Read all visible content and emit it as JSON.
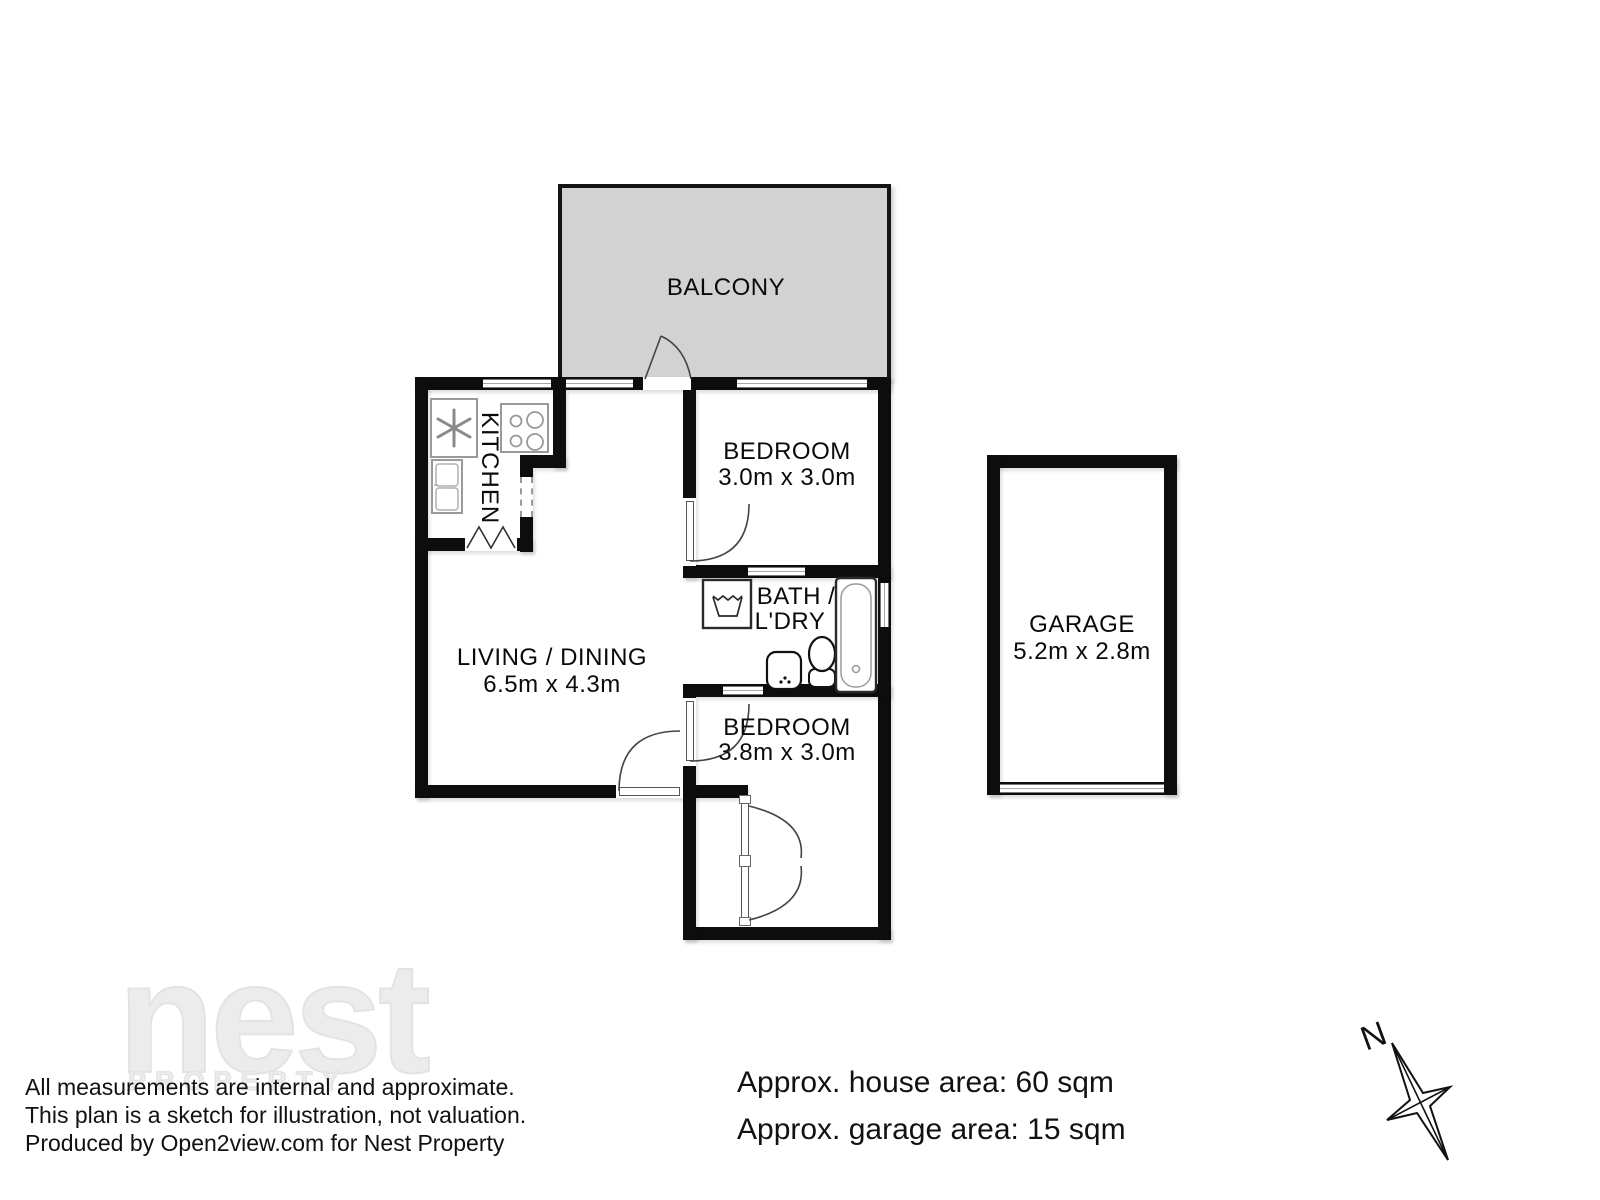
{
  "plan": {
    "balcony_label": "BALCONY",
    "kitchen_label": "KITCHEN",
    "bedroom1": {
      "label": "BEDROOM",
      "dims": "3.0m x 3.0m"
    },
    "living": {
      "label": "LIVING / DINING",
      "dims": "6.5m x 4.3m"
    },
    "bath": {
      "label_line1": "BATH /",
      "label_line2": "L'DRY"
    },
    "bedroom2": {
      "label": "BEDROOM",
      "dims": "3.8m x 3.0m"
    },
    "garage": {
      "label": "GARAGE",
      "dims": "5.2m x 2.8m"
    },
    "compass_label": "N"
  },
  "watermark": {
    "brand": "nest",
    "sub_brand": "PROPERTY"
  },
  "footer": {
    "disclaimer_lines": [
      "All measurements are internal and approximate.",
      "This plan is a sketch for illustration, not valuation.",
      "Produced by Open2view.com for Nest Property"
    ],
    "house_area": "Approx. house area: 60 sqm",
    "garage_area": "Approx. garage area: 15 sqm"
  },
  "colors": {
    "wall": "#0d0d0d",
    "balcony_fill": "#d2d2d2",
    "fixture_gray": "#9a9a9a",
    "fixture_dark": "#222222",
    "watermark_outline": "#e3e3e3"
  }
}
